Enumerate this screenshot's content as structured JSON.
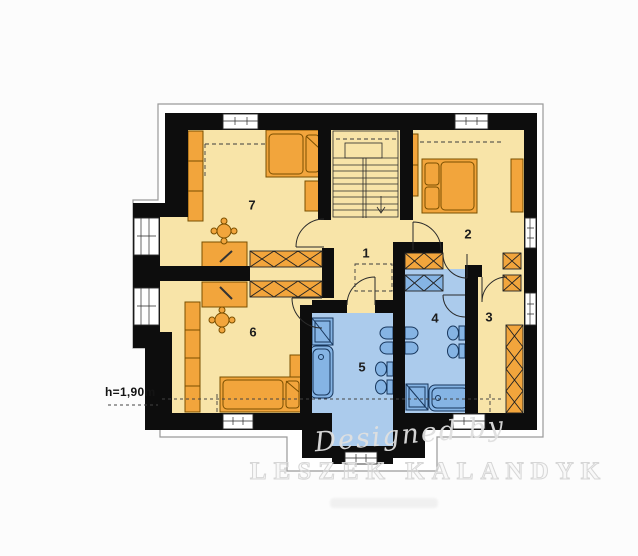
{
  "floor_plan": {
    "height_label": "h=1,90m",
    "rooms": [
      {
        "number": "1"
      },
      {
        "number": "2"
      },
      {
        "number": "3"
      },
      {
        "number": "4"
      },
      {
        "number": "5"
      },
      {
        "number": "6"
      },
      {
        "number": "7"
      }
    ],
    "watermark": {
      "designed_by": "Designed by",
      "author": "LESZEK KALANDYK"
    },
    "palette": {
      "wall": "#0d0d0d",
      "room_fill": "#f8e4a8",
      "furniture_fill": "#f2a53c",
      "bath_fill": "#abcbec",
      "fixture_fill": "#85b4e4",
      "outline": "#9a9a9a",
      "watermark_gray": "#d9d9d9"
    }
  }
}
